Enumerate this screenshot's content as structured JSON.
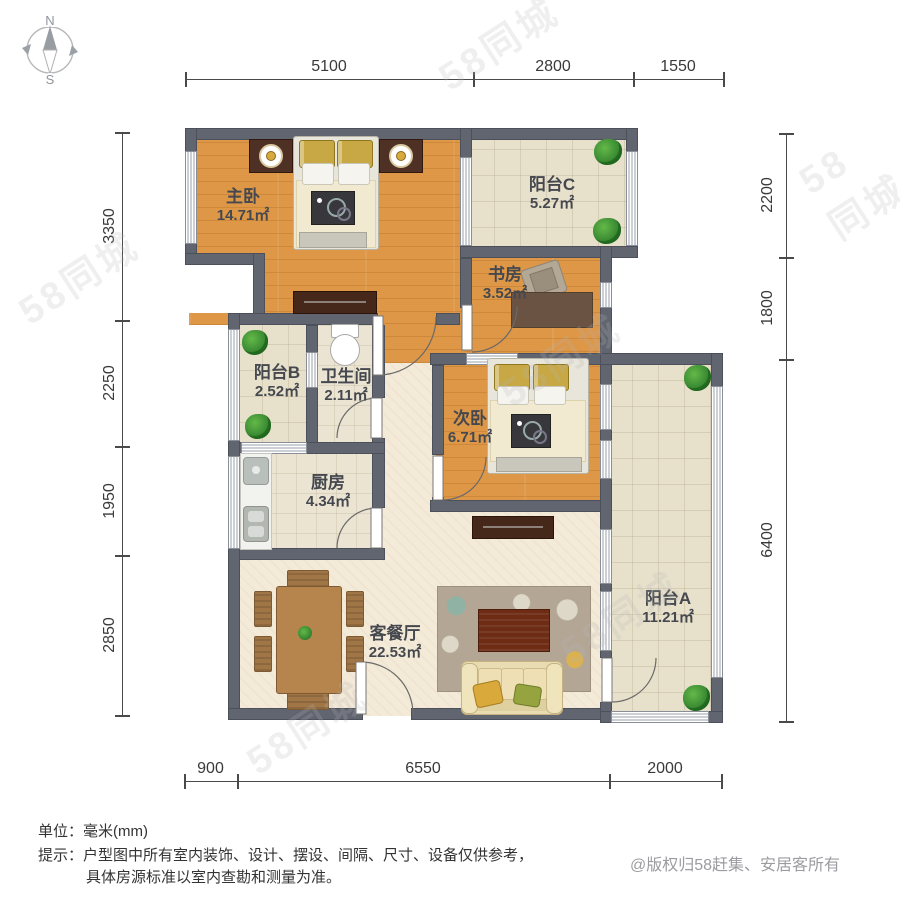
{
  "compass": {
    "north": "N",
    "south": "S"
  },
  "rooms": [
    {
      "id": "master-bedroom",
      "name": "主卧",
      "area": "14.71㎡",
      "x": 243,
      "y": 206
    },
    {
      "id": "balcony-c",
      "name": "阳台C",
      "area": "5.27㎡",
      "x": 552,
      "y": 194
    },
    {
      "id": "study",
      "name": "书房",
      "area": "3.52㎡",
      "x": 505,
      "y": 284
    },
    {
      "id": "balcony-b",
      "name": "阳台B",
      "area": "2.52㎡",
      "x": 277,
      "y": 382
    },
    {
      "id": "bathroom",
      "name": "卫生间",
      "area": "2.11㎡",
      "x": 346,
      "y": 386
    },
    {
      "id": "bedroom-2",
      "name": "次卧",
      "area": "6.71㎡",
      "x": 470,
      "y": 428
    },
    {
      "id": "kitchen",
      "name": "厨房",
      "area": "4.34㎡",
      "x": 328,
      "y": 492
    },
    {
      "id": "living-dining",
      "name": "客餐厅",
      "area": "22.53㎡",
      "x": 395,
      "y": 643
    },
    {
      "id": "balcony-a",
      "name": "阳台A",
      "area": "11.21㎡",
      "x": 668,
      "y": 608
    }
  ],
  "dimensions": {
    "unit_note": "毫米",
    "top": {
      "line_y": 79,
      "segments": [
        {
          "label": "5100",
          "from": 185,
          "to": 473
        },
        {
          "label": "2800",
          "from": 473,
          "to": 633
        },
        {
          "label": "1550",
          "from": 633,
          "to": 723
        }
      ]
    },
    "bottom": {
      "line_y": 781,
      "segments": [
        {
          "label": "900",
          "from": 184,
          "to": 237
        },
        {
          "label": "6550",
          "from": 237,
          "to": 609
        },
        {
          "label": "2000",
          "from": 609,
          "to": 721
        }
      ]
    },
    "left": {
      "line_x": 122,
      "segments": [
        {
          "label": "3350",
          "from": 132,
          "to": 320
        },
        {
          "label": "2250",
          "from": 320,
          "to": 446
        },
        {
          "label": "1950",
          "from": 446,
          "to": 555
        },
        {
          "label": "2850",
          "from": 555,
          "to": 715
        }
      ]
    },
    "right": {
      "line_x": 786,
      "segments": [
        {
          "label": "2200",
          "from": 133,
          "to": 257
        },
        {
          "label": "1800",
          "from": 257,
          "to": 359
        },
        {
          "label": "6400",
          "from": 359,
          "to": 721
        }
      ]
    }
  },
  "footer": {
    "units": "单位：毫米(mm)",
    "tip_line1": "提示：户型图中所有室内装饰、设计、摆设、间隔、尺寸、设备仅供参考，",
    "tip_line2": "具体房源标准以室内查勘和测量为准。",
    "copyright": "@版权归58赶集、安居客所有"
  },
  "watermark": {
    "text": "58同城",
    "positions": [
      [
        430,
        14
      ],
      [
        10,
        248
      ],
      [
        492,
        330
      ],
      [
        812,
        136
      ],
      [
        238,
        698
      ],
      [
        552,
        588
      ]
    ]
  },
  "colors": {
    "wall": "#61656f",
    "wood": "#dd9747",
    "tile": "#e7e0cb",
    "cream": "#f4ead8",
    "plant": "#3f9a3c",
    "gold": "#d8a93c"
  }
}
